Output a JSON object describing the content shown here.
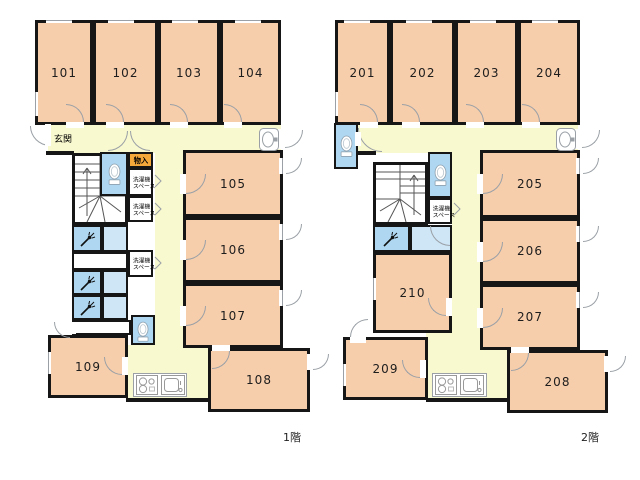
{
  "colors": {
    "wall": "#161616",
    "room": "#F7CEAC",
    "corridor": "#F9F9CF",
    "wet": "#AFD7F1",
    "wet_light": "#CFE6F7",
    "storage_badge": "#F6A93B"
  },
  "floor1": {
    "label": "1階",
    "rooms": [
      "101",
      "102",
      "103",
      "104",
      "105",
      "106",
      "107",
      "108",
      "109"
    ],
    "entrance": "玄関",
    "storage": "物入",
    "laundry_line1": "洗濯機",
    "laundry_line2": "スペース"
  },
  "floor2": {
    "label": "2階",
    "rooms": [
      "201",
      "202",
      "203",
      "204",
      "205",
      "206",
      "207",
      "208",
      "209",
      "210"
    ],
    "laundry_line1": "洗濯機",
    "laundry_line2": "スペース"
  }
}
